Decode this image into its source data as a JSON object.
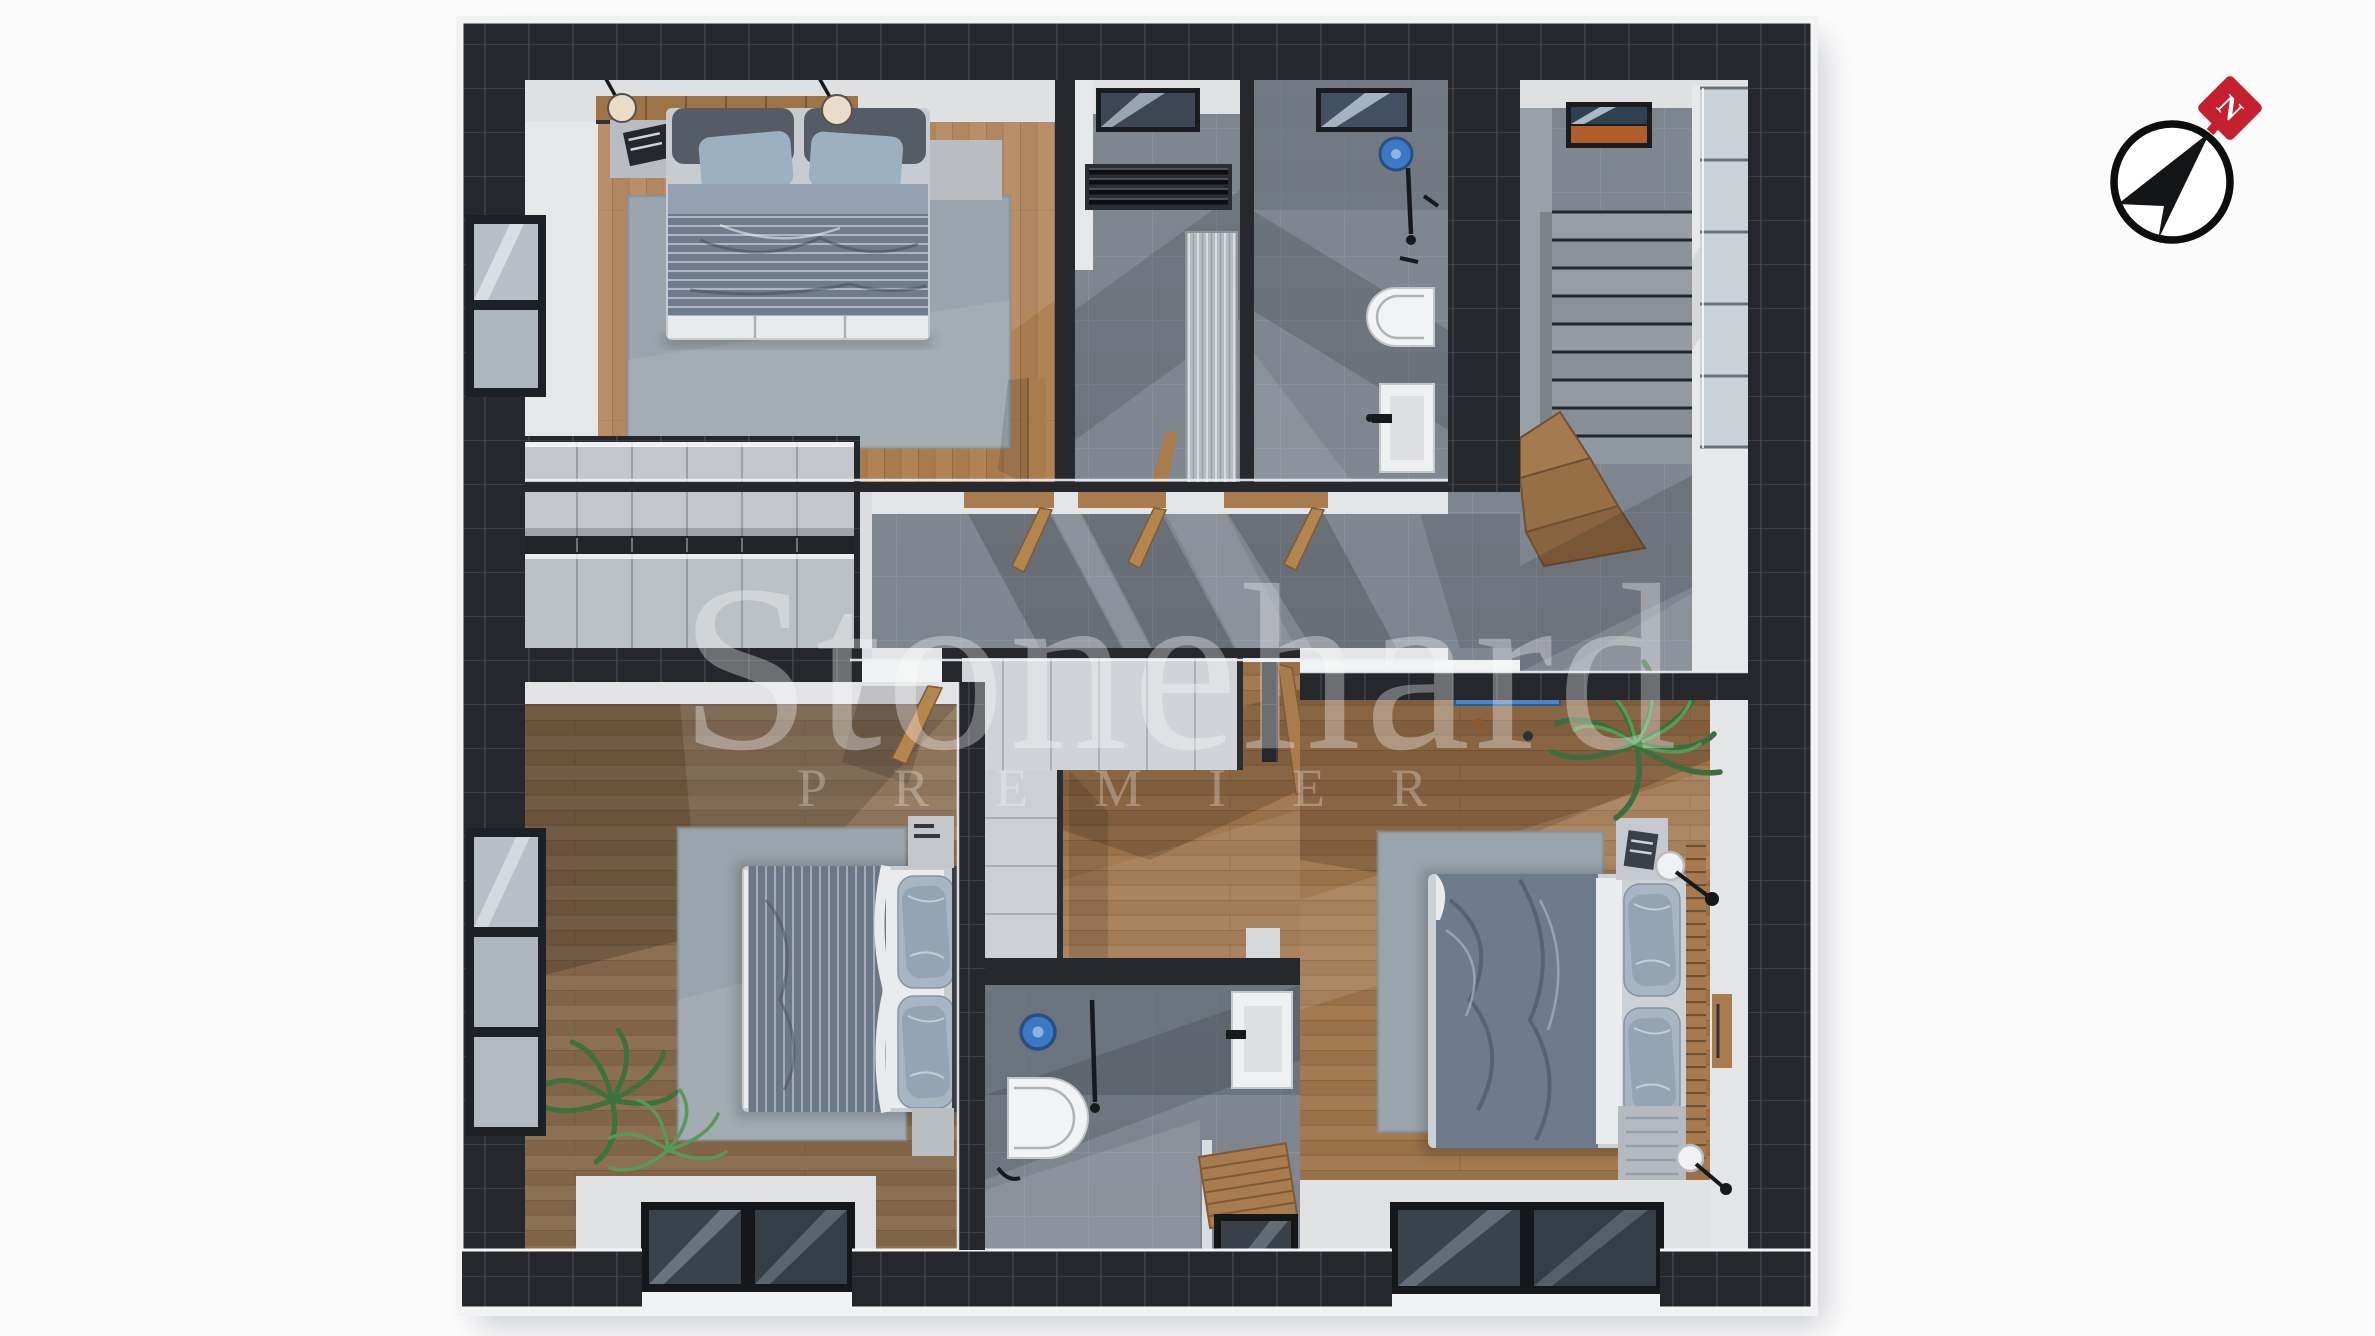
{
  "meta": {
    "kind": "3d-floor-plan-render",
    "view": "top-down",
    "floor": "upper floor with three bedrooms, two bathrooms, utility room, hallway and staircase"
  },
  "watermark": {
    "title": "Stonehard",
    "subtitle": "PREMIER"
  },
  "compass": {
    "name": "north-arrow",
    "points_to": "north-east",
    "badge_letter": "N",
    "badge_color": "#c4202e"
  },
  "palette": {
    "background": "#fbfbfc",
    "wall_dark": "#25272c",
    "wall_grout": "#41454c",
    "trim_white": "#eceef0",
    "wood_bedroom1": "#b28257",
    "wood_bedroom2": "#8c7054",
    "wood_bedroom3": "#a37a52",
    "tile_gray": "#7e858e",
    "rug_gray": "#9aa4ac",
    "duvet_gray": "#6f7c8e",
    "pillow_blue": "#9db0c2",
    "accent_blue": "#3c79c4",
    "plant_green": "#4b8148",
    "door_wood": "#a97c50",
    "compass_red": "#c4202e"
  },
  "rooms": [
    {
      "id": "bedroom-1",
      "label": "bedroom top-left",
      "features": [
        "double-bed",
        "headboard-shelf",
        "pendant-lamp",
        "pendant-lamp",
        "nightstand",
        "nightstand",
        "rug",
        "window",
        "open-door"
      ]
    },
    {
      "id": "utility-room",
      "label": "utility / laundry",
      "features": [
        "skylight",
        "radiator",
        "louver-cabinet"
      ]
    },
    {
      "id": "bathroom-1",
      "label": "bathroom top",
      "features": [
        "skylight",
        "shower-head",
        "shower-bar",
        "toilet",
        "washbasin"
      ]
    },
    {
      "id": "stair-hall",
      "label": "staircase hall",
      "features": [
        "skylight",
        "concrete-stairs",
        "wood-winder-steps",
        "strip-window"
      ]
    },
    {
      "id": "hallway",
      "label": "hallway",
      "features": [
        "door-to-bedroom-1",
        "door-to-utility",
        "door-to-bathroom-1",
        "floor-shadows"
      ]
    },
    {
      "id": "walk-in-closet",
      "label": "double-sided wardrobe",
      "features": [
        "wardrobe-front",
        "wardrobe-front"
      ]
    },
    {
      "id": "bedroom-2",
      "label": "bedroom bottom-left",
      "features": [
        "double-bed",
        "dresser",
        "bench",
        "rug",
        "plant",
        "window",
        "glass-floor-panel",
        "open-door"
      ]
    },
    {
      "id": "bathroom-2",
      "label": "bathroom bottom",
      "features": [
        "shower-head",
        "shower-bar",
        "toilet",
        "washbasin",
        "wood-bench",
        "glass-floor-panel"
      ]
    },
    {
      "id": "vestibule",
      "label": "wood vestibule",
      "features": [
        "l-shaped-cabinet",
        "open-door-to-bedroom-3"
      ]
    },
    {
      "id": "bedroom-3",
      "label": "bedroom bottom-right",
      "features": [
        "double-bed",
        "slat-headboard",
        "nightstand",
        "bench",
        "wall-lamp",
        "wall-lamp",
        "rug",
        "plant",
        "blue-shelf",
        "glass-floor-panel"
      ]
    }
  ]
}
